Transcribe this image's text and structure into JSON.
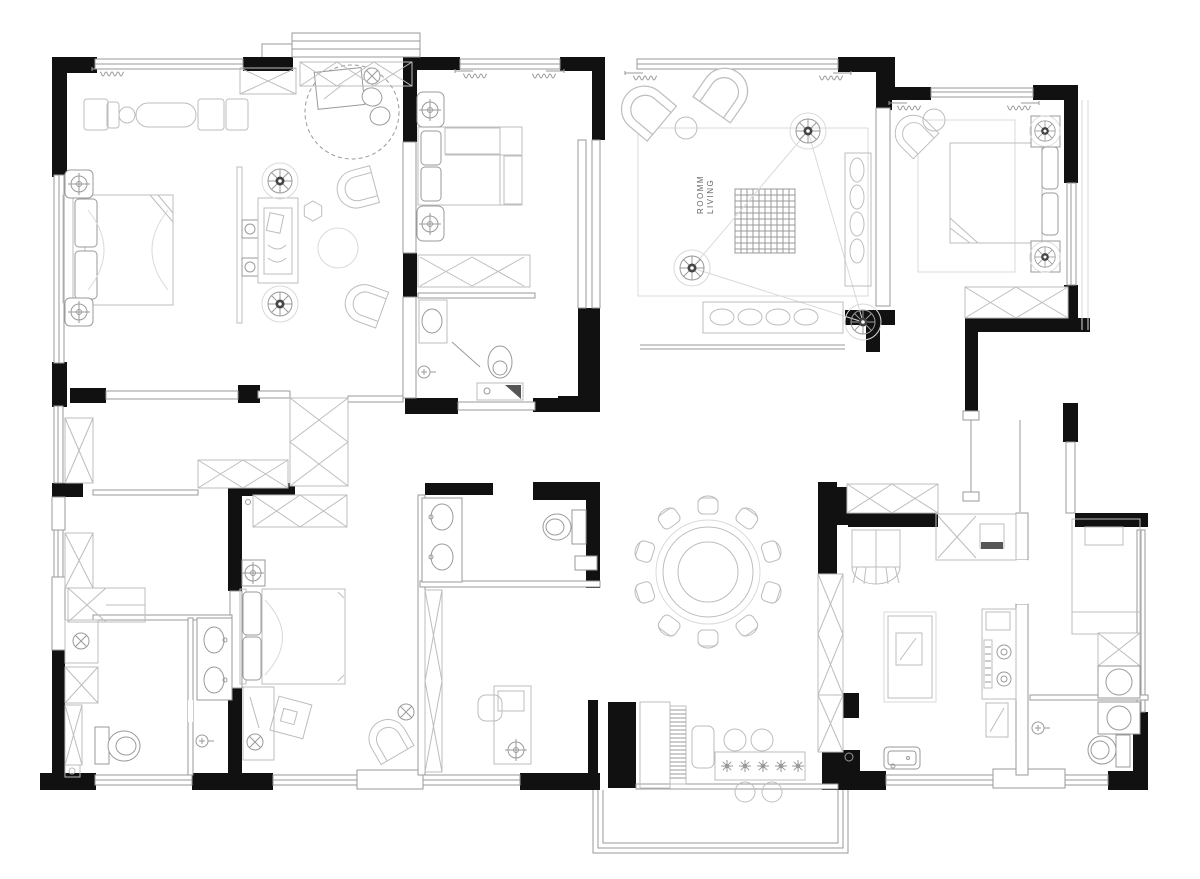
{
  "plan": {
    "living": {
      "label_line1": "ROOMM",
      "label_line2": "LIVING"
    },
    "colors": {
      "wall": "#111111",
      "furniture_line": "#bdbdbd",
      "fixture_line": "#9a9a9a",
      "faint_line": "#dadada",
      "background": "#ffffff"
    }
  }
}
